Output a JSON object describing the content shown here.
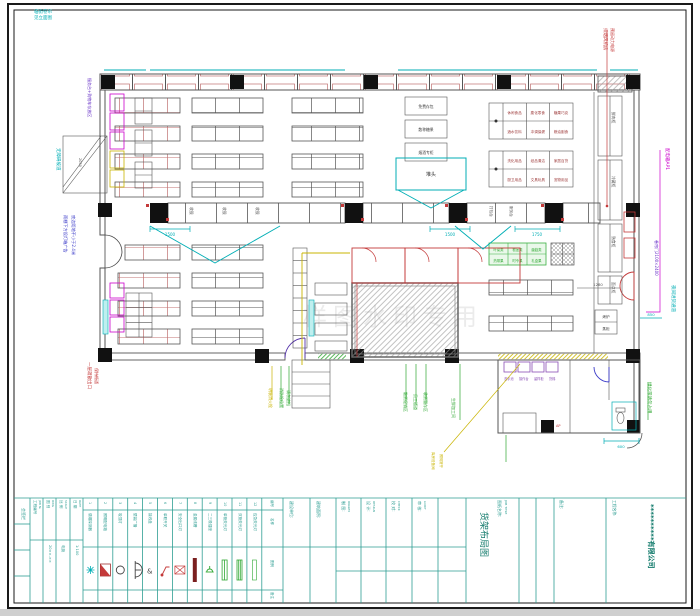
{
  "sheet": {
    "bg": "#ffffff",
    "border": "#1a1a1a"
  },
  "colors": {
    "teal": "#2E9E93",
    "teal_dark": "#117A6B",
    "cyan": "#00AEB5",
    "red": "#C43A3A",
    "brick": "#C07070",
    "magenta": "#CC00CC",
    "purple": "#6A35C8",
    "blue": "#3A3AC8",
    "green": "#2FA832",
    "yellow": "#C9B400",
    "gray": "#555555"
  },
  "plan": {
    "watermark": "样图水印专用",
    "ann": {
      "corner1": "临街卷帘",
      "corner2": "见立面图",
      "service_desk": "服务台+购物车存放区",
      "ramp": "无障碍坡道",
      "ramp_dim": "2050",
      "canopy1": "雨棚下方设灯箱广告",
      "canopy2": "底边距地不小于2.4米",
      "exit1": "一层疏散出口",
      "exit2": "保持畅通",
      "fan1": "排烟风机房",
      "fan2": "预留动力电源",
      "dbox": "配电箱AP1",
      "rolldoor": "卷帘门2100×2400",
      "unload": "夜间进货通道",
      "unload_dim": "850",
      "greenbelt": "绿化带请勿占用",
      "hydrant": "明装消火栓",
      "hydrant2": "消防栓位置",
      "hydrant3": "请勿遮挡",
      "bulk": "散货促销区",
      "staff": "员工通道",
      "receive": "收货暂存区",
      "fresh": "生鲜加工间",
      "store1": "库房设备间",
      "store2": "照明常开",
      "dim1500a": "1500",
      "dim1500b": "1500",
      "dim1750": "1750",
      "dim1280": "1280",
      "dim600": "600"
    },
    "labels": {
      "promo": "堆头",
      "stack": [
        "免费存包",
        "散称糖果",
        "烟酒专柜"
      ],
      "grid1": [
        "休闲食品",
        "膨化零食",
        "糖果巧克",
        "酒水饮料",
        "冲调保健",
        "粮油副食"
      ],
      "grid2": [
        "洗化用品",
        "纸品清洁",
        "家居百货",
        "厨卫用品",
        "文具玩具",
        "宠物用品"
      ],
      "green_grid": [
        "叶菜类",
        "根茎类",
        "菌菇类",
        "热带果",
        "时令果",
        "礼盒果"
      ],
      "corridor": [
        "鲜肉柜",
        "冷藏柜",
        "熟食柜",
        "面点柜"
      ],
      "checkout": [
        "收银",
        "收银",
        "收银"
      ],
      "service_cells": [
        "打包台",
        "服务台"
      ],
      "pair": [
        "烤炉",
        "蒸柜"
      ],
      "fixtures": [
        "洗手池",
        "操作台",
        "留样柜",
        "货梯"
      ],
      "ap": "AP"
    }
  },
  "title_block": {
    "sign_col": "会签栏",
    "left_cols": [
      {
        "h": "工程编号",
        "h2": "JOB №",
        "v": "20××-××"
      },
      {
        "h": "图 别",
        "h2": "DWG",
        "v": "电施"
      },
      {
        "h": "比 例",
        "h2": "SCALE",
        "v": "1:100"
      },
      {
        "h": "日 期",
        "h2": "DATE",
        "v": "20××.××"
      }
    ],
    "legend": {
      "row_labels": [
        "编号",
        "名称",
        "图例",
        "备注"
      ],
      "items": [
        {
          "no": "1",
          "name": "感烟探测器"
        },
        {
          "no": "2",
          "name": "照明配电箱"
        },
        {
          "no": "3",
          "name": "吸顶灯"
        },
        {
          "no": "4",
          "name": "壁装广播"
        },
        {
          "no": "5",
          "name": "接线盒"
        },
        {
          "no": "6",
          "name": "单联开关"
        },
        {
          "no": "7",
          "name": "安全出口灯"
        },
        {
          "no": "8",
          "name": "金属线槽"
        },
        {
          "no": "9",
          "name": "二三极插座"
        },
        {
          "no": "10",
          "name": "单管荧光灯"
        },
        {
          "no": "11",
          "name": "双管荧光灯"
        },
        {
          "no": "12",
          "name": "应急荧光灯"
        }
      ]
    },
    "main_cols": [
      {
        "label": "建设单位:",
        "sub": ""
      },
      {
        "label": "建筑面积:",
        "sub": ""
      },
      {
        "label": "制 图:",
        "sub": "DRAWN"
      },
      {
        "label": "设 计:",
        "sub": "DESIGN"
      },
      {
        "label": "校 对:",
        "sub": "CHECK"
      },
      {
        "label": "审 核:",
        "sub": "AUDIT"
      }
    ],
    "job_title": {
      "label": "图纸名称:",
      "label_en": "JOB TITLE",
      "value": "货架布局图"
    },
    "notes_label": "备注:",
    "company": {
      "label": "工程名称:",
      "value": "**********有限公司"
    }
  }
}
